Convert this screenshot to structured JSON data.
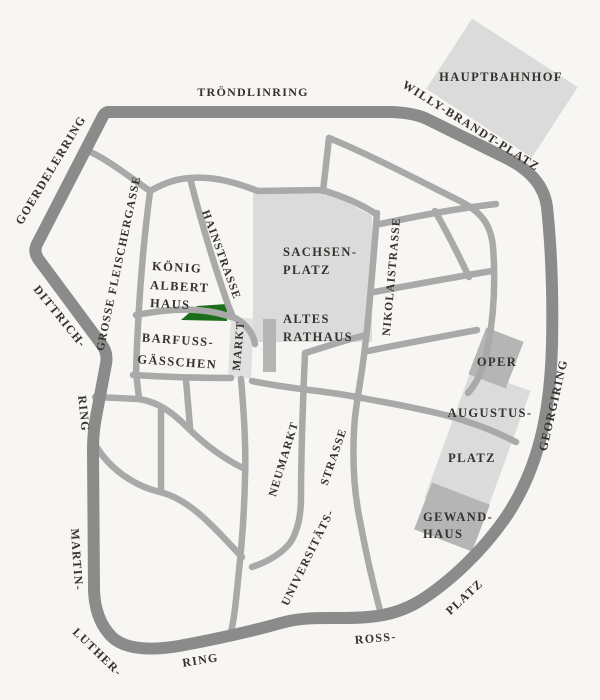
{
  "map": {
    "kind": "city-centre-street-map",
    "colors": {
      "background": "#f8f6f2",
      "ring_road": "#8b8b8b",
      "street": "#a9a9a9",
      "plaza": "#dbdbdb",
      "building": "#b5b5b5",
      "markt_square": "#e0e0e0",
      "highlight_green": "#1d6e1b",
      "label_text": "#35322e"
    },
    "ring": {
      "troendlinring": "TRÖNDLINRING",
      "goerdelerring": "GOERDELERRING",
      "willy_brandt_platz": "WILLY-BRANDT-PLATZ",
      "dittrich": "DITTRICH-",
      "dittrich_ring": "RING",
      "martin": "MARTIN-",
      "luther": "LUTHER-",
      "luther_ring": "RING",
      "ross": "ROSS-",
      "ross_platz": "PLATZ",
      "georgiring": "GEORGIRING"
    },
    "streets": {
      "grosse_fleischergasse": "GROSSE FLEISCHERGASSE",
      "hainstrasse": "HAINSTRASSE",
      "nikolaistrasse": "NIKOLAISTRASSE",
      "neumarkt": "NEUMARKT",
      "universitaets": "UNIVERSITÄTS-",
      "strasse": "STRASSE",
      "markt": "MARKT"
    },
    "places": {
      "hauptbahnhof": "HAUPTBAHNHOF",
      "sachsenplatz_line1": "SACHSEN-",
      "sachsenplatz_line2": "PLATZ",
      "altes_rathaus_line1": "ALTES",
      "altes_rathaus_line2": "RATHAUS",
      "koenig_albert_haus_line1": "KÖNIG",
      "koenig_albert_haus_line2": "ALBERT",
      "koenig_albert_haus_line3": "HAUS",
      "barfussgaesschen_line1": "BARFUSS-",
      "barfussgaesschen_line2": "GÄSSCHEN",
      "oper": "OPER",
      "augustusplatz_line1": "AUGUSTUS-",
      "augustusplatz_line2": "PLATZ",
      "gewandhaus_line1": "GEWAND-",
      "gewandhaus_line2": "HAUS"
    }
  }
}
